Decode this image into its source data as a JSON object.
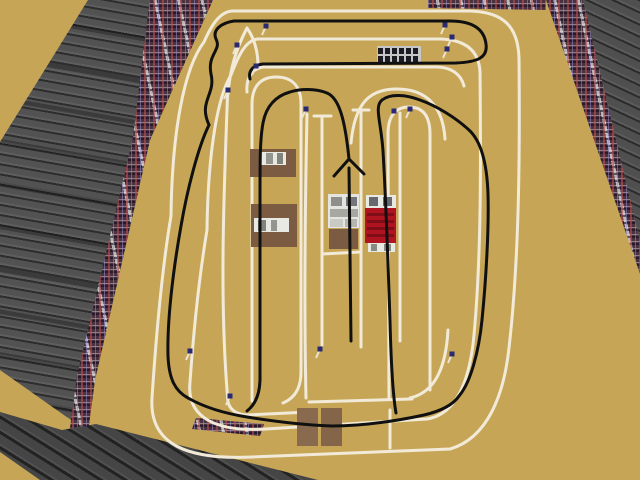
{
  "colors": {
    "field": "#c6a656",
    "track-line": "#f2ead8",
    "racing-line": "#101010",
    "crowd-base": "#4a3240",
    "curb": "#c8c8c0",
    "ministand-cell": "#1b1b24",
    "ministand-frame": "#c6c6c6",
    "marker-pole": "#ece4d0",
    "marker-dot": "#2a2a72"
  },
  "track": {
    "edge_line_width": 3,
    "racing_line_width": 3,
    "edge_paths": [
      {
        "name": "outer-boundary",
        "d": "M232,11 L470,11 C504,12 518,27 519,58 C520,160 519,260 509,348 C504,394 488,438 450,449 L252,457 C188,460 149,445 152,398 C157,322 164,257 171,216 C172,132 184,68 204,42 C212,24 220,12 232,11 Z"
      },
      {
        "name": "second-boundary",
        "d": "M258,39 L441,39 C466,40 479,51 480,72 C481,170 481,260 474,335 C470,378 458,414 427,419 L266,429 C218,432 186,419 190,382 C195,311 201,266 207,230 C208,150 218,96 231,75 C239,54 246,40 258,39 Z"
      },
      {
        "name": "chicane-lower-line",
        "d": "M247,92 C246,79 251,69 263,67 L436,67 C451,67 461,74 464,86"
      },
      {
        "name": "chicane-left-v",
        "d": "M228,94 C230,69 236,49 247,28 C254,38 258,51 258,66"
      },
      {
        "name": "left-hairpin-island",
        "d": "M252,401 L252,104 C252,86 261,77 276,77 C292,77 301,86 301,104 L301,372 C301,388 295,398 283,403"
      },
      {
        "name": "lane-line-left",
        "d": "M228,83 C224,190 219,300 228,402 C230,410 236,414 246,415"
      },
      {
        "name": "lane-line-mid",
        "d": "M307,114 C305,210 304,310 306,398"
      },
      {
        "name": "grid-line-1",
        "d": "M322,117 L322,345"
      },
      {
        "name": "grid-line-2",
        "d": "M361,111 L361,347"
      },
      {
        "name": "grid-cap-1",
        "d": "M314,116 L331,116"
      },
      {
        "name": "grid-cap-2",
        "d": "M353,110 L369,110"
      },
      {
        "name": "grid-box-bottom",
        "d": "M322,254 L361,252"
      },
      {
        "name": "grid-line-3",
        "d": "M400,113 L400,341"
      },
      {
        "name": "right-hairpin-island",
        "d": "M389,398 L388,134 C388,115 396,107 409,107 C423,107 430,116 430,134 L430,390"
      },
      {
        "name": "right-hairpin-arc",
        "d": "M351,143 C355,101 371,89 397,89 C427,89 443,107 445,139"
      },
      {
        "name": "bottom-lane-edge",
        "d": "M309,402 L412,399"
      },
      {
        "name": "bottom-lane-edge-2",
        "d": "M246,415 L309,412"
      },
      {
        "name": "bottom-right-corner-line",
        "d": "M448,330 C446,366 436,392 410,398"
      },
      {
        "name": "pit-stub",
        "d": "M390,448 L390,410"
      }
    ],
    "racing_paths": [
      {
        "name": "racing-line-top-chicane",
        "d": "M209,125 C198,101 216,95 211,74 C207,54 222,50 216,39 C212,30 221,23 234,21 L450,21 C471,21 484,28 486,44 C488,58 477,62 456,63 L263,64 C253,65 248,71 250,79"
      },
      {
        "name": "racing-line-main-loop",
        "d": "M209,125 C198,147 187,191 181,226 C173,271 167,321 168,356 C169,379 175,391 188,398 C202,406 222,413 247,417 C272,421 302,425 332,426 C362,426 396,421 424,415 C441,411 453,405 459,396 C471,382 479,350 482,320 C486,280 489,229 488,194 C487,164 481,141 469,130 C456,118 437,106 420,100 C407,95 391,93 382,100 C374,107 381,121 383,151 C386,201 388,261 390,321 C391,361 393,396 396,413"
      },
      {
        "name": "racing-line-start-arrow",
        "d": "M351,341 L349,168 M349,159 L334,176 M349,159 L364,174 M349,159 C345,119 339,98 327,93 C315,88 299,89 290,92 C276,96 266,106 263,123 C260,139 260,159 260,199 L260,378 C260,393 256,404 247,411"
      }
    ]
  },
  "markers": [
    [
      266,
      27
    ],
    [
      237,
      46
    ],
    [
      256,
      67
    ],
    [
      228,
      91
    ],
    [
      306,
      110
    ],
    [
      394,
      112
    ],
    [
      410,
      110
    ],
    [
      445,
      26
    ],
    [
      452,
      38
    ],
    [
      447,
      50
    ],
    [
      190,
      352
    ],
    [
      230,
      397
    ],
    [
      320,
      350
    ],
    [
      452,
      355
    ]
  ],
  "vehicles": [
    {
      "name": "flatbed-truck-brown-1",
      "rects": [
        [
          250,
          149,
          46,
          28,
          "#7b5b41"
        ],
        [
          260,
          152,
          26,
          13,
          "#e9e9e4"
        ],
        [
          266,
          153,
          7,
          11,
          "#95958f"
        ],
        [
          277,
          153,
          6,
          11,
          "#83837d"
        ]
      ]
    },
    {
      "name": "flatbed-truck-brown-2",
      "rects": [
        [
          251,
          204,
          46,
          43,
          "#7b5b41"
        ],
        [
          254,
          218,
          35,
          14,
          "#e9e9e4"
        ],
        [
          258,
          220,
          8,
          11,
          "#83837d"
        ],
        [
          271,
          220,
          6,
          11,
          "#95958f"
        ]
      ]
    },
    {
      "name": "truck-white-grid",
      "rects": [
        [
          328,
          194,
          31,
          34,
          "#e4e4e0"
        ],
        [
          331,
          197,
          11,
          9,
          "#8e8e8a"
        ],
        [
          346,
          197,
          11,
          9,
          "#74747a"
        ],
        [
          330,
          209,
          28,
          8,
          "#a8a8a2"
        ],
        [
          330,
          219,
          13,
          8,
          "#cacac4"
        ],
        [
          345,
          219,
          12,
          8,
          "#b6b6b0"
        ],
        [
          329,
          229,
          29,
          20,
          "#7b5b41"
        ]
      ]
    },
    {
      "name": "truck-red-grid",
      "rects": [
        [
          366,
          195,
          30,
          13,
          "#e9e9e4"
        ],
        [
          369,
          197,
          9,
          9,
          "#676770"
        ],
        [
          383,
          197,
          9,
          9,
          "#676770"
        ],
        [
          365,
          208,
          31,
          35,
          "#b01420"
        ],
        [
          367,
          213,
          27,
          3,
          "#800e18"
        ],
        [
          367,
          220,
          27,
          3,
          "#800e18"
        ],
        [
          367,
          227,
          27,
          3,
          "#800e18"
        ],
        [
          367,
          234,
          27,
          3,
          "#800e18"
        ],
        [
          368,
          243,
          27,
          9,
          "#e9e9e4"
        ],
        [
          371,
          244,
          6,
          7,
          "#8a8a84"
        ],
        [
          384,
          244,
          7,
          7,
          "#8a8a84"
        ]
      ]
    },
    {
      "name": "crate-brown-1",
      "rects": [
        [
          297,
          408,
          21,
          38,
          "#8a6a4e"
        ]
      ]
    },
    {
      "name": "crate-brown-2",
      "rects": [
        [
          321,
          408,
          21,
          38,
          "#856549"
        ]
      ]
    }
  ],
  "structures": {
    "trackside_grandstand": {
      "x": 377,
      "y": 46,
      "w": 44,
      "h": 17
    }
  }
}
